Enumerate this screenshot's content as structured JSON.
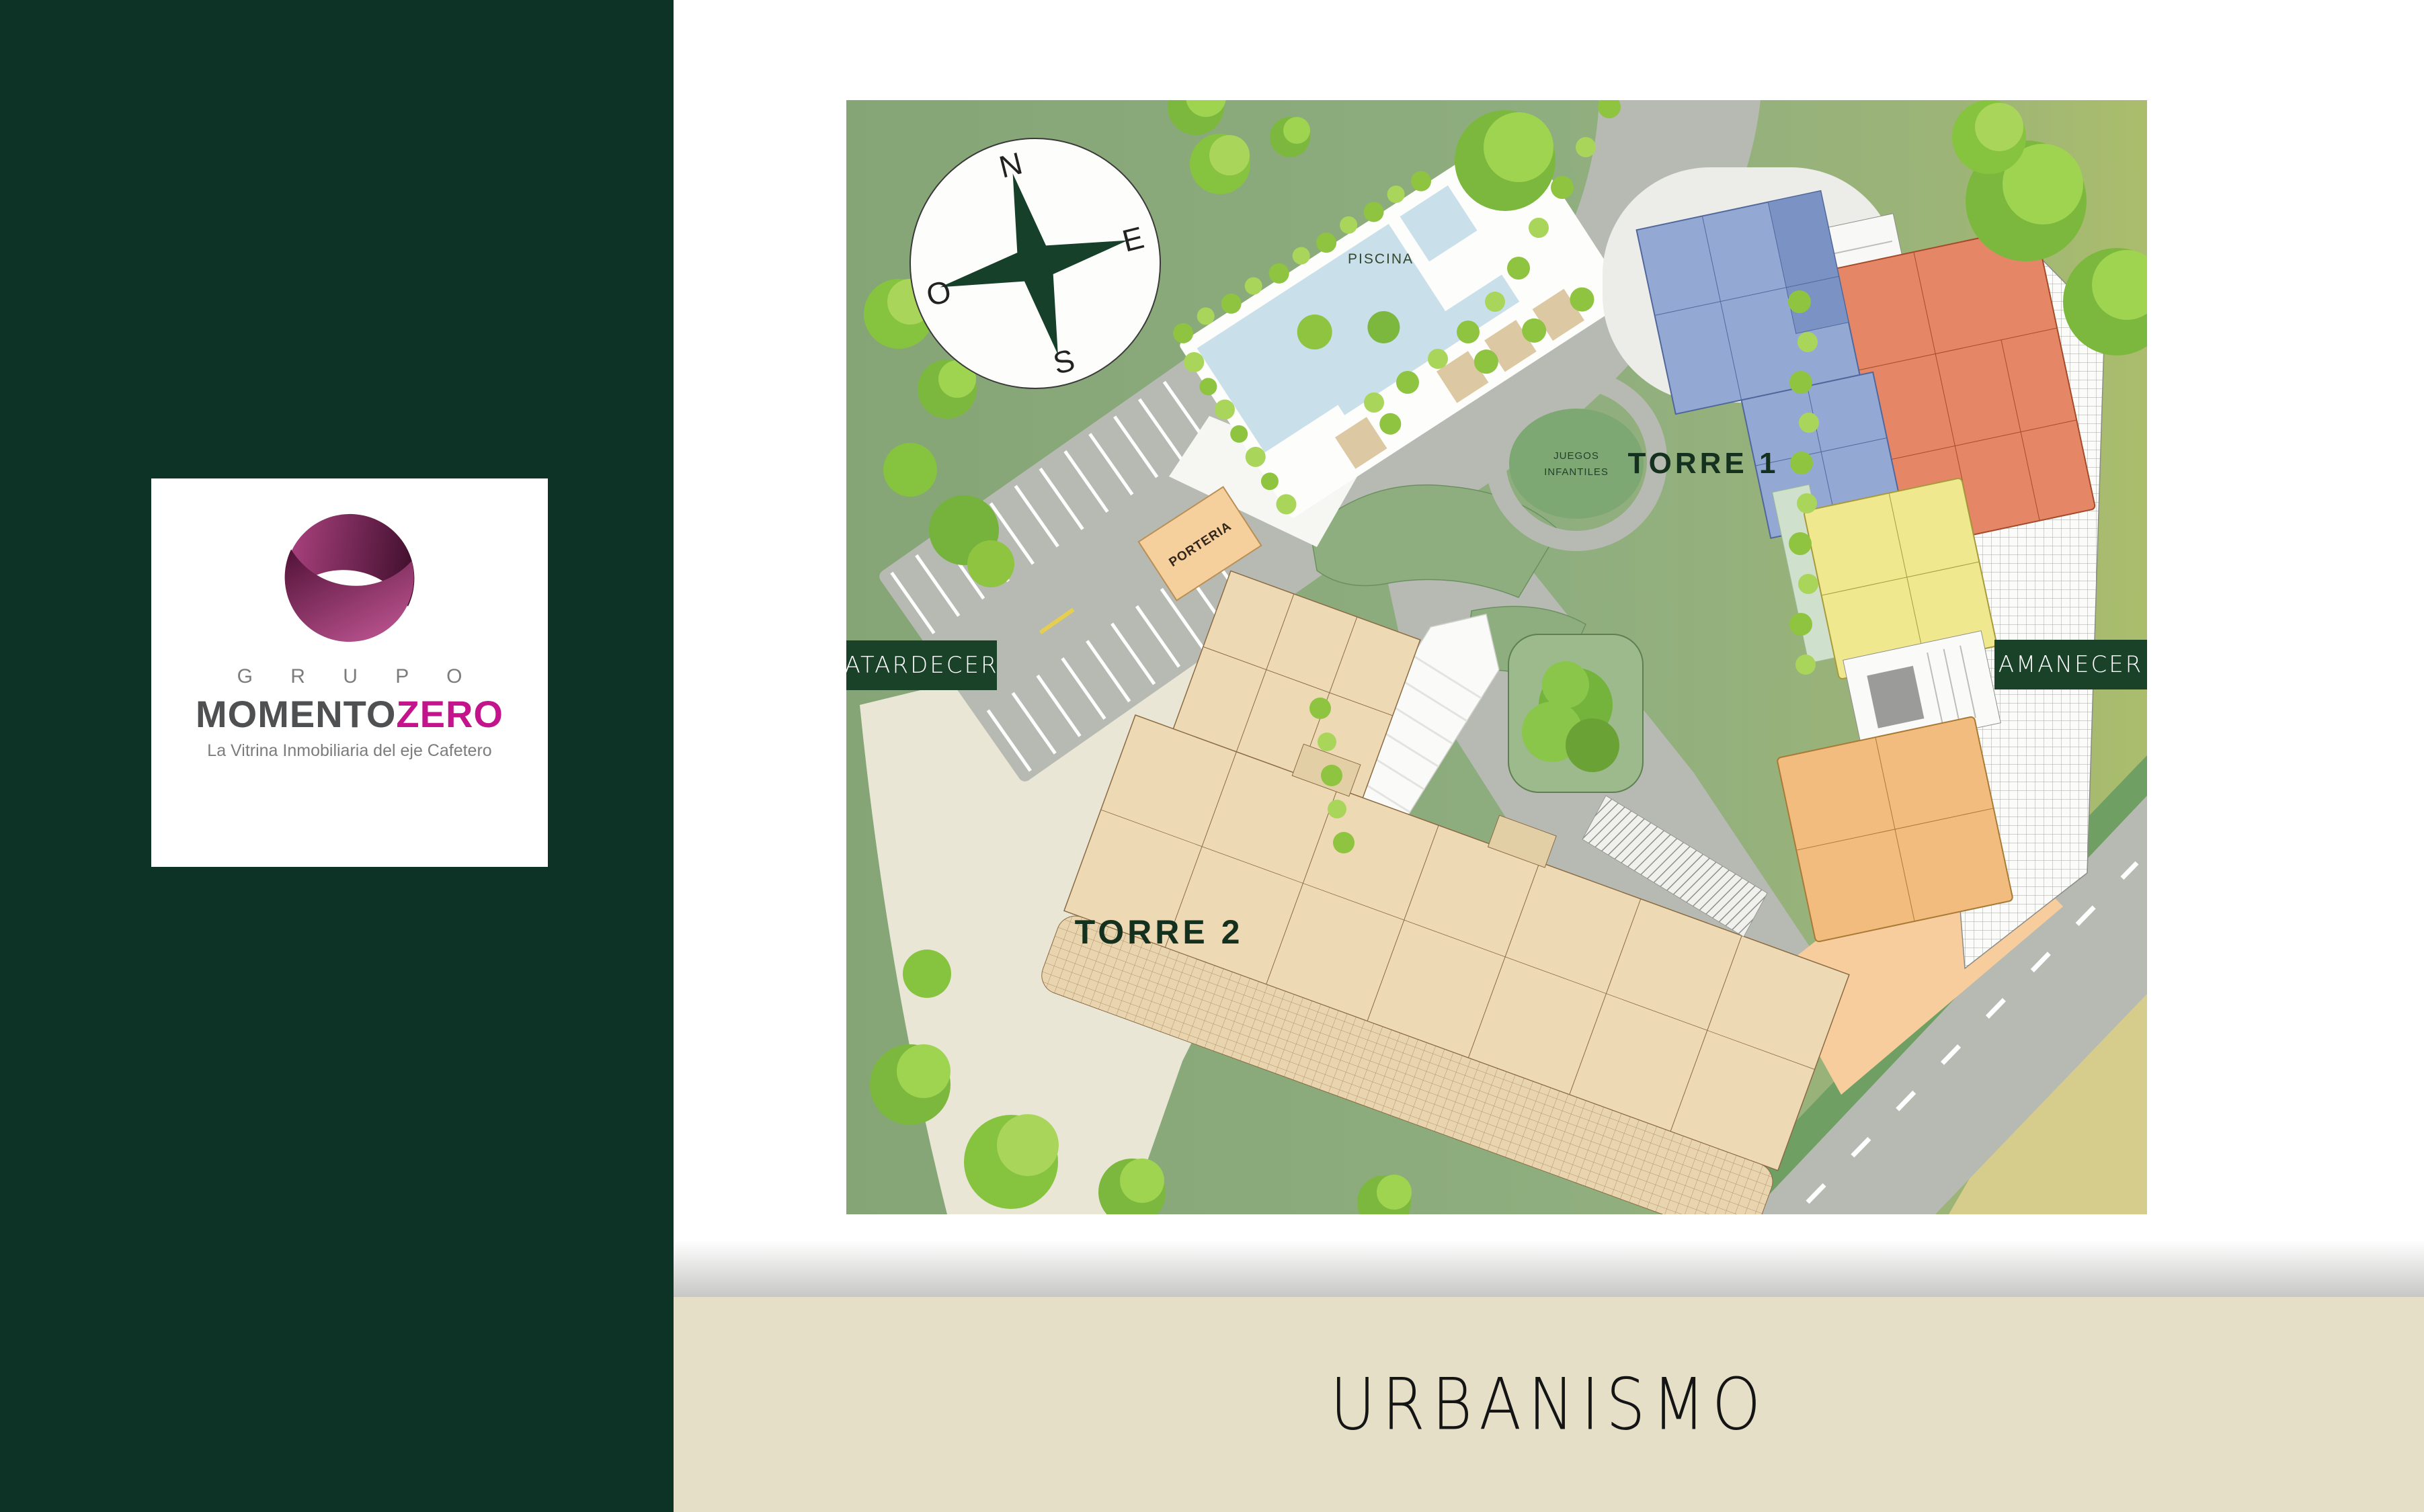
{
  "brand": {
    "grupo": "G R U P O",
    "momento": "MOMENTO",
    "zero": "ZERO",
    "tagline": "La Vitrina Inmobiliaria del eje Cafetero"
  },
  "map": {
    "labels": {
      "piscina": "PISCINA",
      "juegos_line1": "JUEGOS",
      "juegos_line2": "INFANTILES",
      "porteria": "PORTERIA",
      "torre1": "TORRE 1",
      "torre2": "TORRE 2"
    },
    "badges": {
      "west": "ATARDECER",
      "east": "AMANECER"
    },
    "compass": {
      "n": "N",
      "e": "E",
      "s": "S",
      "o": "O"
    }
  },
  "footer": {
    "title": "URBANISMO"
  },
  "colors": {
    "sidebar_green": "#0c3325",
    "badge_green": "#194229",
    "footer_beige": "#e5dfc8",
    "brand_magenta": "#c3148b",
    "map_green": "#8dac7c",
    "road_gray": "#b7bab2",
    "pool_blue": "#c9dfe9",
    "torre2_tan": "#eed9b5",
    "unit_blue": "#93a9d4",
    "unit_salmon": "#e58767",
    "unit_yellow": "#f0e88f",
    "unit_orange": "#f2bc7e"
  }
}
